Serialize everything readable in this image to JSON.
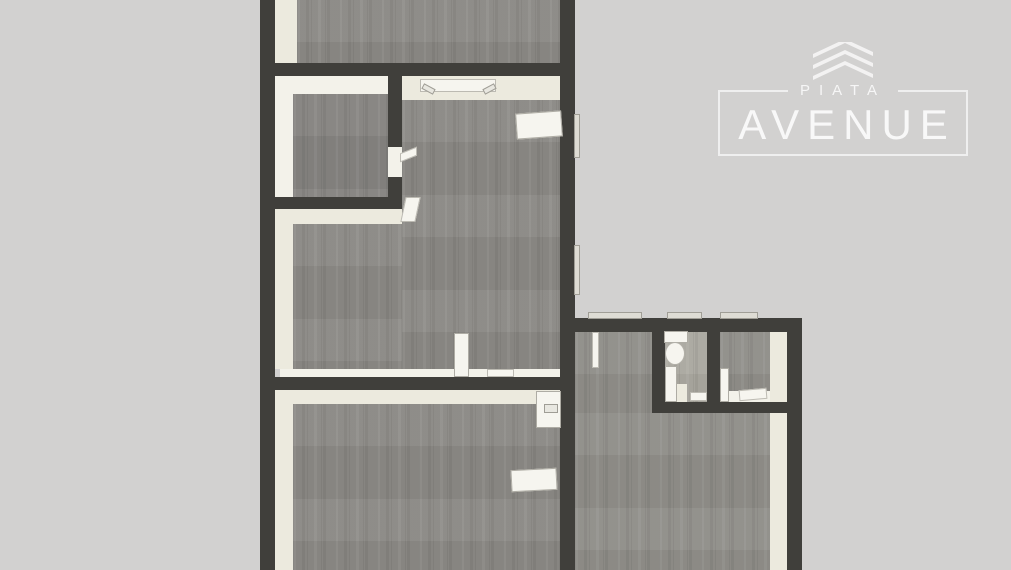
{
  "branding": {
    "line1": "PIATA",
    "line2": "AVENUE",
    "icon": "stacked-chevrons-logo-icon",
    "text_color": "rgba(255,255,255,0.8)"
  },
  "plan": {
    "type": "floor-plan-3d-top-down-render",
    "rooms": [
      {
        "name": "top-room"
      },
      {
        "name": "small-room-left"
      },
      {
        "name": "main-room"
      },
      {
        "name": "bottom-room"
      },
      {
        "name": "right-wing-room"
      },
      {
        "name": "bathroom"
      },
      {
        "name": "small-room-right"
      }
    ],
    "fixtures": [
      {
        "name": "toilet",
        "room": "bathroom"
      },
      {
        "name": "open-door",
        "count": 6
      },
      {
        "name": "windowsill",
        "room": "main-room"
      },
      {
        "name": "wall-cabinet",
        "room": "bottom-room"
      },
      {
        "name": "table",
        "room": "bottom-room"
      },
      {
        "name": "window",
        "count": 5
      }
    ],
    "palette": {
      "background": "#d2d1d0",
      "wall": "#403f3b",
      "floor": "#8b8985",
      "inner_wall_face": "#eceade",
      "fixture": "#f6f5ef"
    }
  }
}
